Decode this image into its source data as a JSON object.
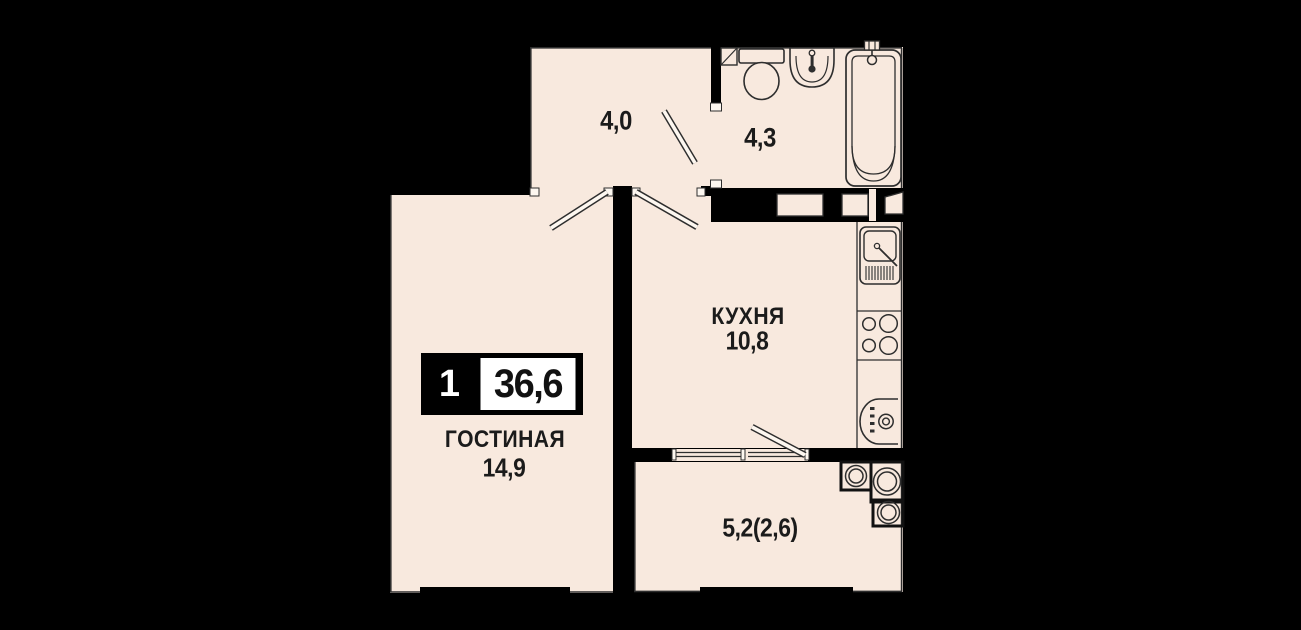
{
  "plan": {
    "type": "apartment-floor-plan",
    "badge": {
      "rooms_count": "1",
      "total_area": "36,6"
    },
    "rooms": {
      "hallway": {
        "area": "4,0"
      },
      "bathroom": {
        "area": "4,3"
      },
      "kitchen": {
        "name": "КУХНЯ",
        "area": "10,8"
      },
      "living": {
        "name": "ГОСТИНАЯ",
        "area": "14,9"
      },
      "balcony": {
        "area": "5,2(2,6)"
      }
    },
    "fixtures": [
      "toilet",
      "wash-basin",
      "bathtub",
      "kitchen-sink",
      "stove",
      "washing-machine",
      "utility-risers"
    ],
    "colors": {
      "background": "#000000",
      "floor": "#f8e9de",
      "wall": "#000000",
      "line": "#2e2e2e",
      "door_leaf": "#fdf7f0",
      "badge_bg": "#000000",
      "badge_fg": "#ffffff",
      "text": "#1b1b1b"
    }
  }
}
